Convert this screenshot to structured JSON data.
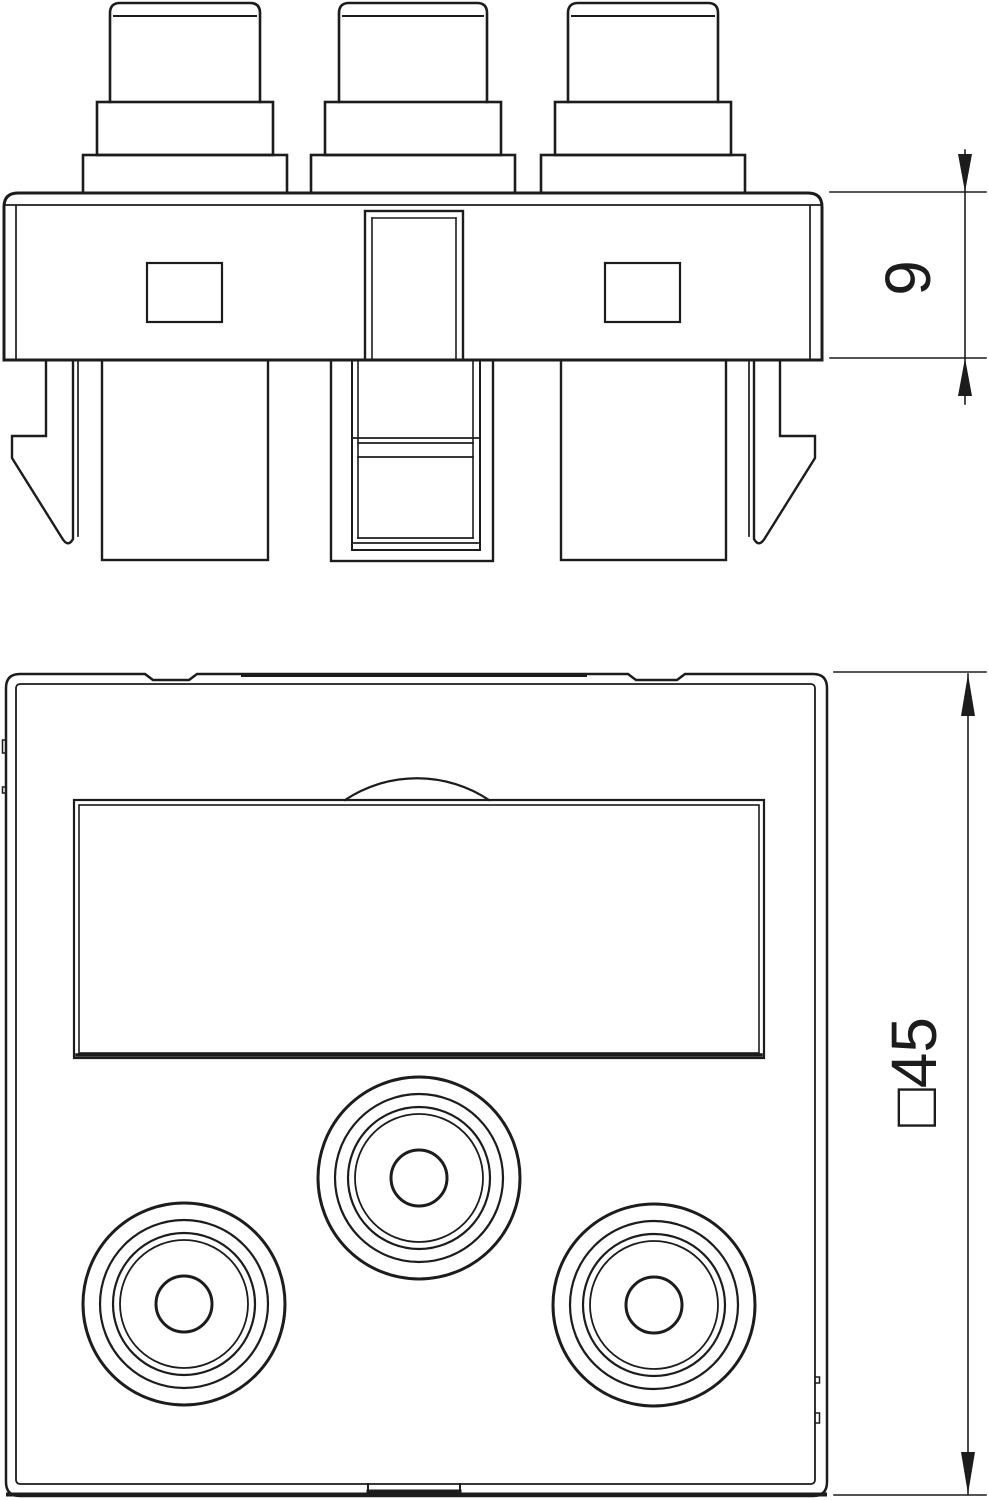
{
  "drawing": {
    "background_color": "#ffffff",
    "line_color": "#1c1c1c",
    "views": {
      "side": {
        "label": "9"
      },
      "front": {
        "label": "□45"
      }
    }
  }
}
